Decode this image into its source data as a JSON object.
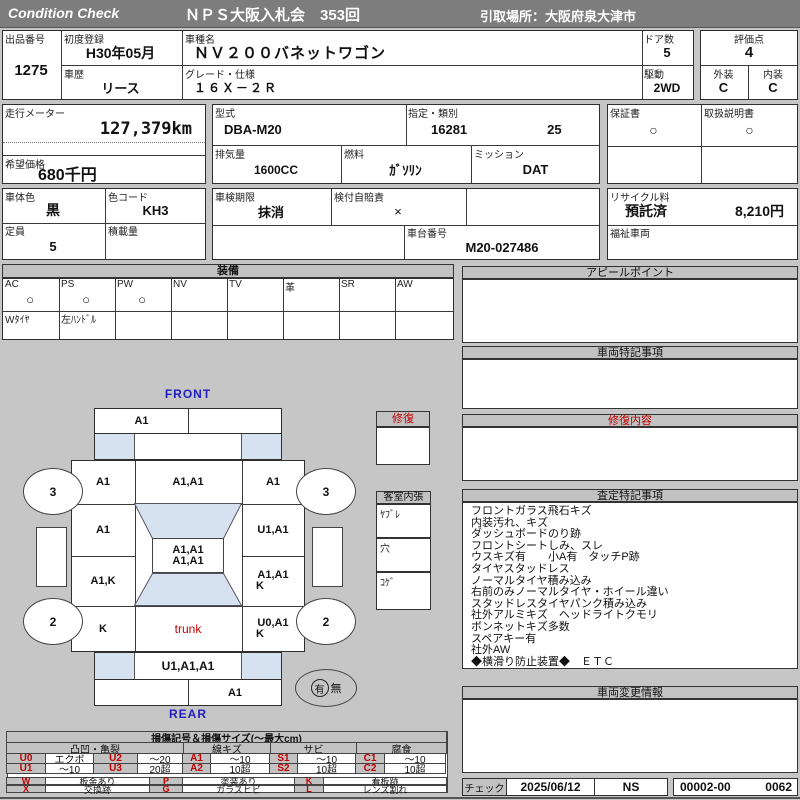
{
  "header": {
    "brand": "Condition  Check",
    "title": "ＮＰＳ大阪入札会　353回",
    "pickup": "引取場所：大阪府泉大津市"
  },
  "info": {
    "lot_label": "出品番号",
    "lot": "1275",
    "first_reg_label": "初度登録",
    "first_reg": "H30年05月",
    "history_label": "車歴",
    "history": "リース",
    "model_label": "車種名",
    "model": "ＮＶ２００バネットワゴン",
    "grade_label": "グレード・仕様",
    "grade": "１６Ｘ－２Ｒ",
    "doors_label": "ドア数",
    "doors": "5",
    "drive_label": "駆動",
    "drive": "2WD",
    "score_label": "評価点",
    "score": "4",
    "exterior_label": "外装",
    "exterior": "C",
    "interior_label": "内装",
    "interior": "C"
  },
  "meter": {
    "odo_label": "走行メーター",
    "odo": "127,379km",
    "price_label": "希望価格",
    "price": "680千円"
  },
  "spec": {
    "model_code_label": "型式",
    "model_code": "DBA-M20",
    "class_label": "指定・類別",
    "class_no": "16281",
    "class_no2": "25",
    "displacement_label": "排気量",
    "displacement": "1600CC",
    "fuel_label": "燃料",
    "fuel": "ｶﾞｿﾘﾝ",
    "mission_label": "ミッション",
    "mission": "DAT",
    "warranty_label": "保証書",
    "warranty": "○",
    "manual_label": "取扱説明書",
    "manual": "○"
  },
  "reg": {
    "body_color_label": "車体色",
    "body_color": "黒",
    "color_code_label": "色コード",
    "color_code": "KH3",
    "inspection_label": "車検期限",
    "inspection": "抹消",
    "insurance_label": "検付自賠責",
    "insurance": "×",
    "capacity_label": "定員",
    "capacity": "5",
    "load_label": "積載量",
    "load": "",
    "chassis_label": "車台番号",
    "chassis": "M20-027486",
    "recycle_label": "リサイクル料",
    "recycle_status": "預託済",
    "recycle_fee": "8,210円",
    "welfare_label": "福祉車両",
    "welfare": ""
  },
  "equip": {
    "title": "装備",
    "cols": [
      {
        "label": "AC",
        "mark": "○"
      },
      {
        "label": "PS",
        "mark": "○"
      },
      {
        "label": "PW",
        "mark": "○"
      },
      {
        "label": "NV",
        "mark": ""
      },
      {
        "label": "TV",
        "mark": ""
      },
      {
        "label": "革",
        "mark": ""
      },
      {
        "label": "SR",
        "mark": ""
      },
      {
        "label": "AW",
        "mark": ""
      }
    ],
    "row2": [
      "Wﾀｲﾔ",
      "左ﾊﾝﾄﾞﾙ",
      "",
      "",
      "",
      "",
      "",
      ""
    ]
  },
  "panels": {
    "appeal_title": "アピールポイント",
    "notes_title": "車両特記事項",
    "repair_title": "修復内容",
    "assessment_title": "査定特記事項",
    "assessment_items": [
      "フロントガラス飛石キズ",
      "内装汚れ、キズ",
      "ダッシュボードのり跡",
      "フロントシートしみ、スレ",
      "ウスキズ有　　小A有　タッチP跡",
      "タイヤスタッドレス",
      "ノーマルタイヤ積み込み",
      "右前のみノーマルタイヤ・ホイール違い",
      "スタッドレスタイヤパンク積み込み",
      "社外アルミキズ　ヘッドライトクモリ",
      "ボンネットキズ多数",
      "スペアキー有",
      "社外AW",
      "◆横滑り防止装置◆　ＥＴＣ"
    ],
    "change_title": "車両変更情報"
  },
  "check": {
    "label": "チェック",
    "date": "2025/06/12",
    "inspector": "NS",
    "no1": "00002-00",
    "no2": "0062"
  },
  "diagram": {
    "front_label": "FRONT",
    "rear_label": "REAR",
    "repair_box_title": "修復",
    "cabin_box_title": "客室内張",
    "cabin_rows": [
      "ﾔﾌﾞﾚ",
      "穴",
      "ｺｹﾞ"
    ],
    "front_bumper_left": "A1",
    "fender_left": "A1",
    "hood": "A1,A1",
    "fender_right": "A1",
    "door_front_left": "A1",
    "door_front_right": "U1,A1",
    "roof_line1": "A1,A1",
    "roof_line2": "A1,A1",
    "door_rear_left": "A1,K",
    "door_rear_right_line1": "A1,A1",
    "door_rear_right_line2": "K",
    "quarter_left": "K",
    "trunk": "trunk",
    "quarter_right_line1": "U0,A1",
    "quarter_right_line2": "K",
    "rear_gate": "U1,A1,A1",
    "rear_bumper_right": "A1",
    "wheel_front_left": "3",
    "wheel_front_right": "3",
    "wheel_rear_left": "2",
    "wheel_rear_right": "2",
    "spare_yes": "有",
    "spare_no": "無"
  },
  "legend": {
    "title": "損傷記号＆損傷サイズ(～最大cm)",
    "groups": [
      "凸凹・亀裂",
      "線キズ",
      "サビ",
      "腐食"
    ],
    "row1": [
      {
        "code": "U0",
        "val": "エクボ"
      },
      {
        "code": "U2",
        "val": "～20"
      },
      {
        "code": "A1",
        "val": "～10"
      },
      {
        "code": "S1",
        "val": "～10"
      },
      {
        "code": "C1",
        "val": "～10"
      }
    ],
    "row2": [
      {
        "code": "U1",
        "val": "～10"
      },
      {
        "code": "U3",
        "val": "20超"
      },
      {
        "code": "A2",
        "val": "10超"
      },
      {
        "code": "S2",
        "val": "10超"
      },
      {
        "code": "C2",
        "val": "10超"
      }
    ],
    "row3": [
      {
        "code": "W",
        "val": "板金あり"
      },
      {
        "code": "P",
        "val": "塗装あり"
      },
      {
        "code": "K",
        "val": "看板跡"
      }
    ],
    "row4": [
      {
        "code": "X",
        "val": "交換跡"
      },
      {
        "code": "G",
        "val": "ガラスヒビ"
      },
      {
        "code": "L",
        "val": "レンズ割れ"
      }
    ]
  },
  "colors": {
    "accent_red": "#c00000",
    "accent_blue": "#2020c0",
    "glass_blue": "#d6e2ef",
    "header_gray": "#7d7d7d"
  }
}
